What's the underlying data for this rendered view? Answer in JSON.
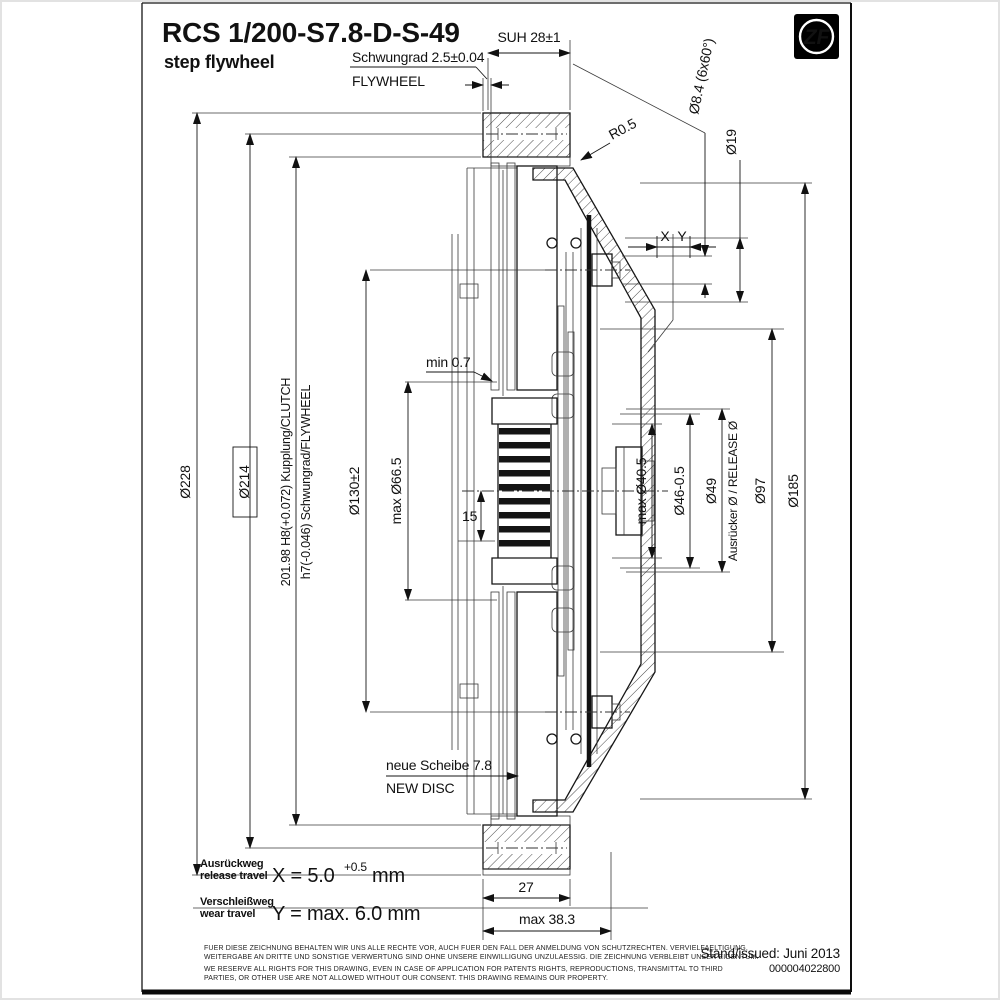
{
  "page": {
    "title": "RCS 1/200-S7.8-D-S-49",
    "subtitle": "step flywheel",
    "logo_text": "ZF",
    "issued_label": "Stand/issued: Juni 2013",
    "doc_number": "000004022800"
  },
  "dims": {
    "suh": "SUH 28±1",
    "flywheel_step_de": "Schwungrad 2.5±0.04",
    "flywheel_step_en": "FLYWHEEL",
    "holes": "Ø8.4 (6x60°)",
    "dia19": "Ø19",
    "r05": "R0.5",
    "x_label": "X",
    "y_label": "Y",
    "dia228": "Ø228",
    "dia214": "Ø214",
    "fit_clutch": "201.98 H8(+0.072) Kupplung/CLUTCH",
    "fit_flywheel": "h7(-0.046) Schwungrad/FLYWHEEL",
    "dia130": "Ø130±2",
    "dia66": "max Ø66.5",
    "min07": "min 0.7",
    "n15": "15",
    "dia40": "max Ø40.5",
    "dia46": "Ø46-0.5",
    "dia49": "Ø49",
    "release": "Ausrücker Ø / RELEASE Ø",
    "dia97": "Ø97",
    "dia185": "Ø185",
    "new_disc_de": "neue Scheibe 7.8",
    "new_disc_en": "NEW DISC",
    "d27": "27",
    "d383": "max 38.3"
  },
  "travel": {
    "x_de": "Ausrückweg",
    "x_en": "release travel",
    "x_formula": "X = 5.0",
    "x_sup": "+0.5",
    "x_unit": "mm",
    "y_de": "Verschleißweg",
    "y_en": "wear travel",
    "y_formula": "Y = max. 6.0 mm"
  },
  "footer": {
    "de1": "FUER DIESE ZEICHNUNG BEHALTEN WIR UNS ALLE RECHTE VOR, AUCH FUER DEN FALL DER ANMELDUNG VON SCHUTZRECHTEN. VERVIELFAELTIGUNG,",
    "de2": "WEITERGABE AN DRITTE UND SONSTIGE VERWERTUNG SIND OHNE UNSERE EINWILLIGUNG UNZULAESSIG. DIE ZEICHNUNG VERBLEIBT UNSER EIGENTUM.",
    "en1": "WE RESERVE ALL RIGHTS FOR THIS DRAWING, EVEN IN CASE OF APPLICATION FOR PATENTS RIGHTS, REPRODUCTIONS, TRANSMITTAL TO THIRD",
    "en2": "PARTIES, OR OTHER USE ARE NOT ALLOWED WITHOUT OUR CONSENT. THIS DRAWING REMAINS OUR PROPERTY."
  },
  "colors": {
    "line": "#1a1a1a",
    "paper": "#ffffff",
    "logo_bg": "#000000"
  }
}
